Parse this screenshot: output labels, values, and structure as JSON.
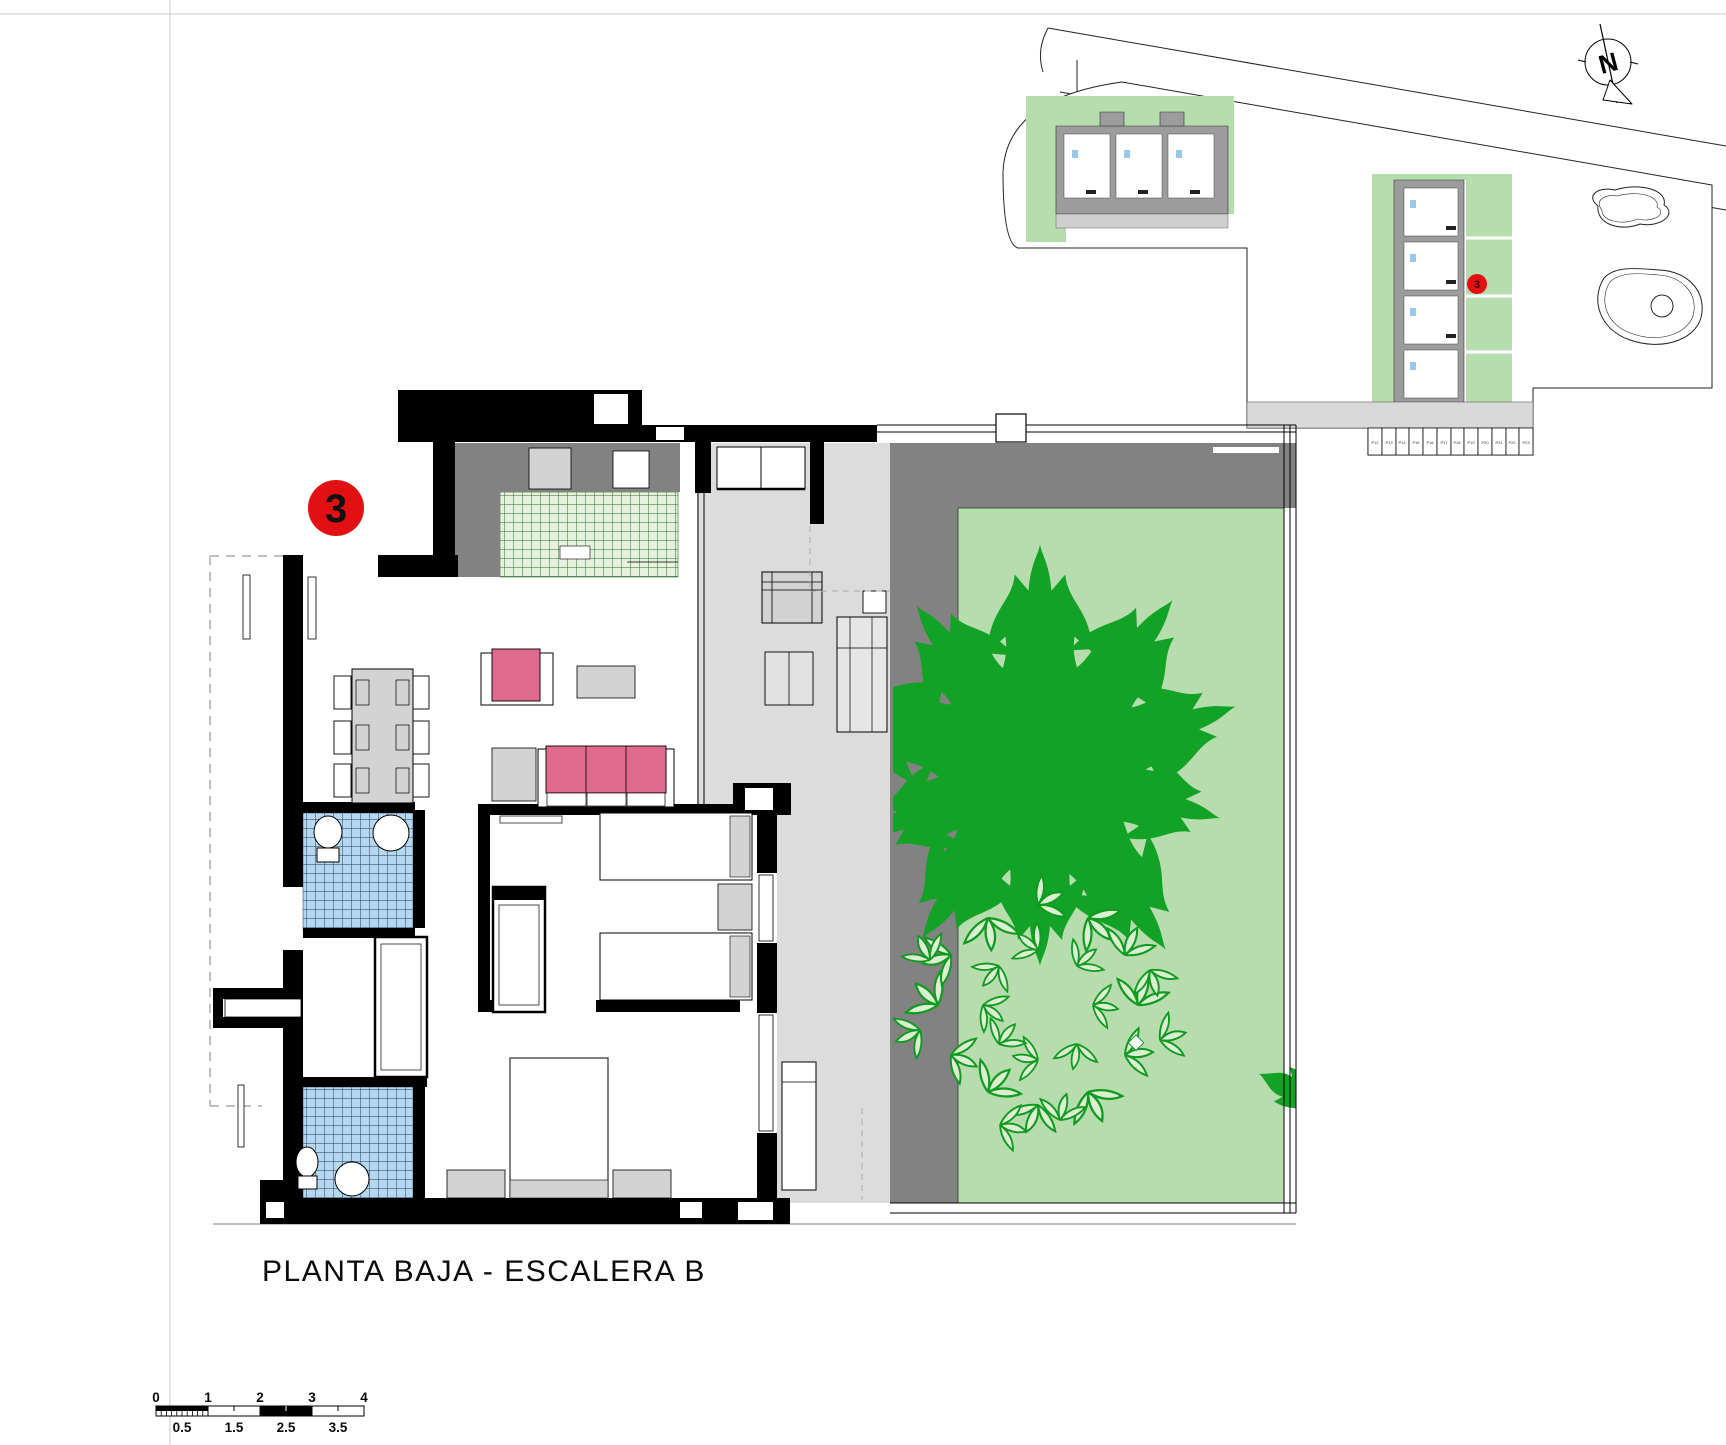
{
  "drawing": {
    "title": "PLANTA BAJA - ESCALERA B",
    "unit_badge": "3"
  },
  "site_plan": {
    "unit_badge": "3",
    "north_label": "N",
    "parking_labels": [
      "P12",
      "P13",
      "P14",
      "P15",
      "P16",
      "P17",
      "P18",
      "P19",
      "P20",
      "P21",
      "P22",
      "P23"
    ]
  },
  "scale_bar": {
    "major_ticks": [
      "0",
      "1",
      "2",
      "3",
      "4"
    ],
    "half_ticks": [
      "0.5",
      "1.5",
      "2.5",
      "3.5"
    ]
  },
  "colors": {
    "wall_black": "#000000",
    "terrace_floor": "#dcdcdc",
    "planter_gray": "#828282",
    "counter_gray": "#828282",
    "furniture_gray": "#d3d3d3",
    "garden_green": "#b7dcae",
    "tree_green": "#12a226",
    "kitchen_tile": "#e6f1de",
    "kitchen_grid": "#2f6b2f",
    "bath_tile": "#b5d7ef",
    "bath_grid": "#223a55",
    "sofa_pink": "#e0698e",
    "marker_red": "#e31013",
    "site_building_gray": "#9c9c9c"
  }
}
